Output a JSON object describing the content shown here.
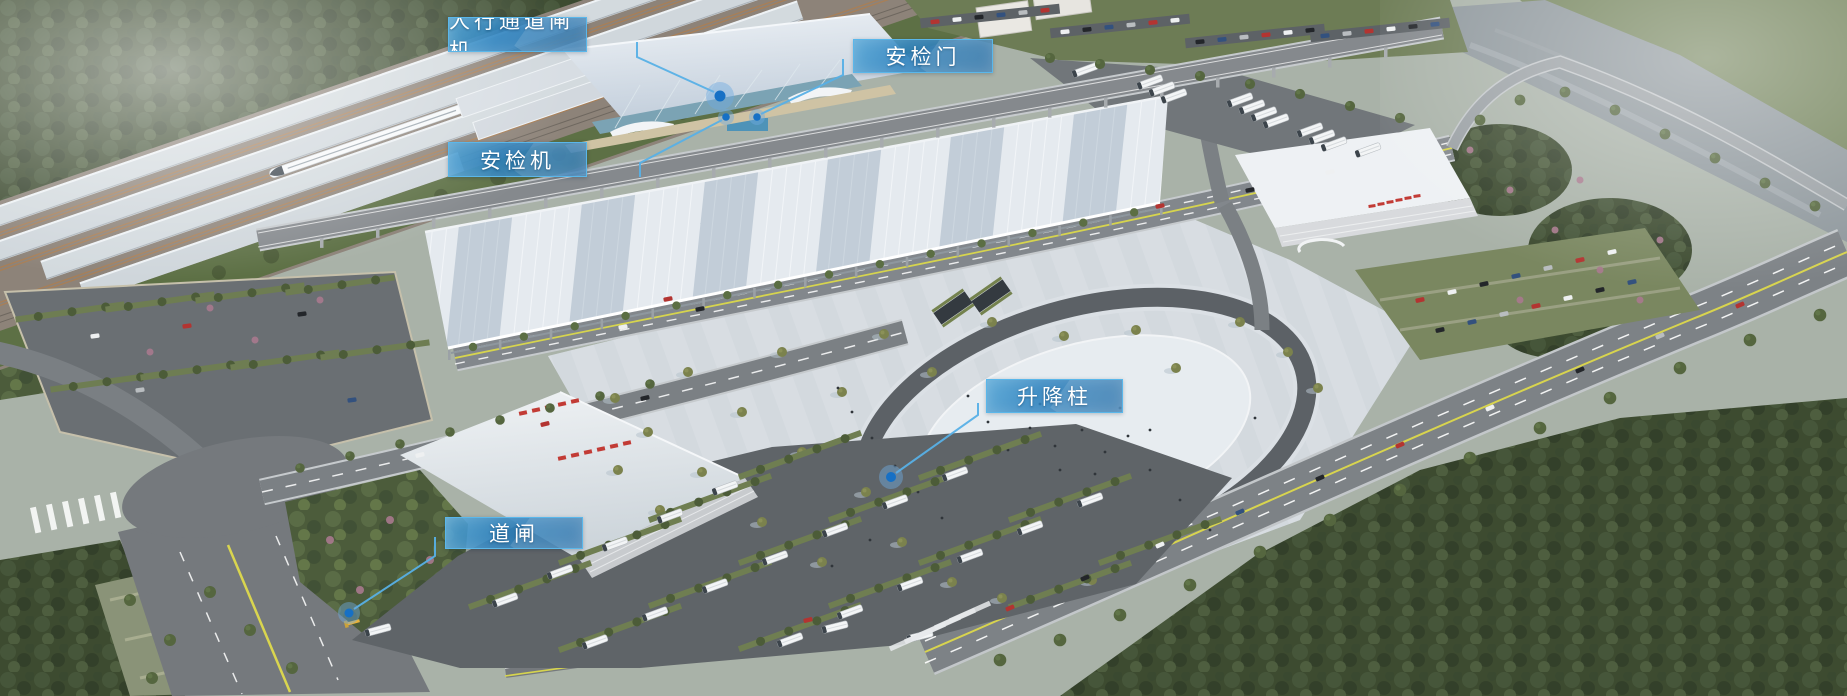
{
  "image_kind": "aerial-rendering-annotated",
  "callouts": [
    {
      "id": "pedestrian-channel-gate",
      "label": "人行通道闸机",
      "box": {
        "x": 448,
        "y": 17,
        "w": 139,
        "h": 35
      },
      "line": [
        [
          637,
          42
        ],
        [
          637,
          57
        ],
        [
          714,
          92
        ]
      ],
      "dot": {
        "x": 720,
        "y": 96,
        "r": 5.5,
        "halo": 14
      }
    },
    {
      "id": "security-door",
      "label": "安检门",
      "box": {
        "x": 853,
        "y": 39,
        "w": 140,
        "h": 34
      },
      "line": [
        [
          843,
          59
        ],
        [
          843,
          75
        ],
        [
          761,
          114
        ]
      ],
      "dot": {
        "x": 757,
        "y": 117,
        "r": 3.8,
        "halo": 8
      }
    },
    {
      "id": "security-scanner",
      "label": "安检机",
      "box": {
        "x": 448,
        "y": 142,
        "w": 139,
        "h": 35
      },
      "line": [
        [
          640,
          177
        ],
        [
          640,
          163
        ],
        [
          722,
          120
        ]
      ],
      "dot": {
        "x": 726,
        "y": 117,
        "r": 3.8,
        "halo": 8
      }
    },
    {
      "id": "lifting-bollard",
      "label": "升降柱",
      "box": {
        "x": 986,
        "y": 379,
        "w": 137,
        "h": 34
      },
      "line": [
        [
          978,
          403
        ],
        [
          978,
          415
        ],
        [
          896,
          473
        ]
      ],
      "dot": {
        "x": 891,
        "y": 477,
        "r": 5,
        "halo": 12
      }
    },
    {
      "id": "road-barrier",
      "label": "道闸",
      "box": {
        "x": 445,
        "y": 517,
        "w": 138,
        "h": 32
      },
      "line": [
        [
          435,
          537
        ],
        [
          435,
          556
        ],
        [
          354,
          609
        ]
      ],
      "dot": {
        "x": 349,
        "y": 613,
        "r": 4.5,
        "halo": 11
      }
    }
  ],
  "colors": {
    "callout_border": "#5ab7ea",
    "leader_line": "#57b0e6",
    "marker_core": "#1670c5",
    "marker_halo": "rgba(110,170,225,0.45)",
    "label_text": "#ffffff"
  }
}
